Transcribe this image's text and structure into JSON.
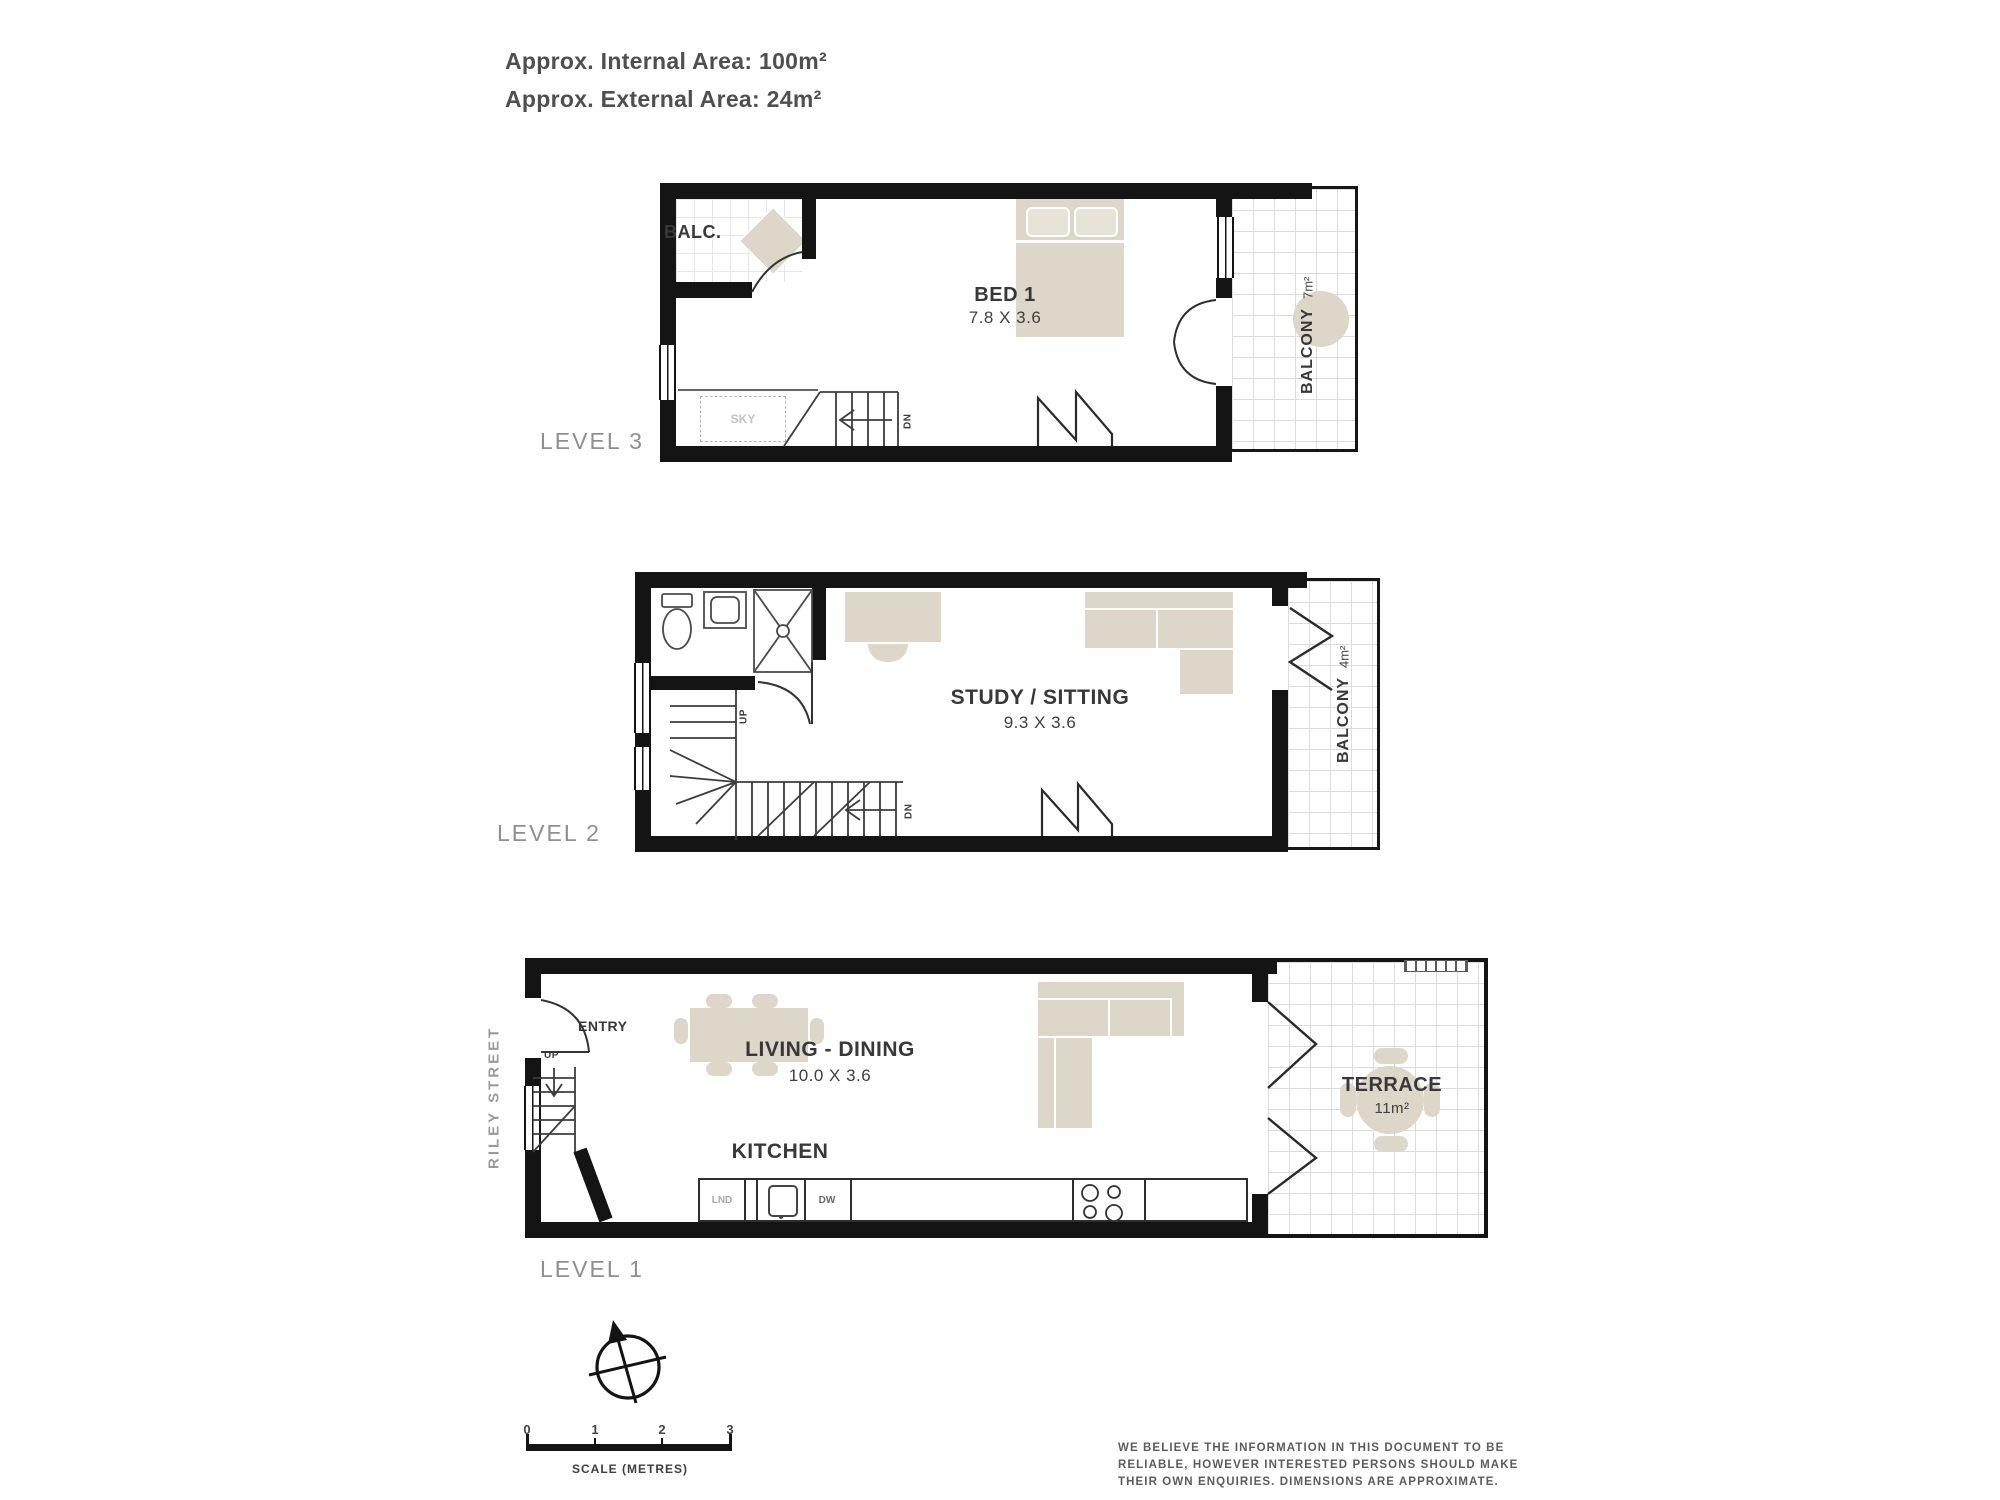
{
  "header": {
    "internal_area": "Approx. Internal Area: 100m²",
    "external_area": "Approx. External Area: 24m²"
  },
  "levels": {
    "level3": {
      "label": "LEVEL 3",
      "balc_label": "BALC.",
      "bed": {
        "name": "BED 1",
        "dims": "7.8 X 3.6"
      },
      "balcony": {
        "name": "BALCONY",
        "area": "7m²"
      },
      "sky_label": "SKY",
      "down_label": "DN"
    },
    "level2": {
      "label": "LEVEL 2",
      "study": {
        "name": "STUDY / SITTING",
        "dims": "9.3 X 3.6"
      },
      "balcony": {
        "name": "BALCONY",
        "area": "4m²"
      },
      "up_label": "UP",
      "down_label": "DN"
    },
    "level1": {
      "label": "LEVEL 1",
      "street_label": "RILEY STREET",
      "entry_label": "ENTRY",
      "up_label": "UP",
      "living": {
        "name": "LIVING - DINING",
        "dims": "10.0 X 3.6"
      },
      "kitchen_label": "KITCHEN",
      "laundry_label": "LND",
      "dishwasher_label": "DW",
      "terrace": {
        "name": "TERRACE",
        "area": "11m²"
      }
    }
  },
  "scale_bar": {
    "ticks": [
      "0",
      "1",
      "2",
      "3"
    ],
    "label": "SCALE (METRES)"
  },
  "disclaimer": {
    "line1": "WE BELIEVE THE INFORMATION IN THIS DOCUMENT TO BE",
    "line2": "RELIABLE, HOWEVER INTERESTED PERSONS SHOULD MAKE",
    "line3": "THEIR OWN ENQUIRIES. DIMENSIONS ARE APPROXIMATE."
  },
  "colors": {
    "wall": "#141414",
    "furniture": "#dcd7c9",
    "level_label_gray": "#8f8f8f",
    "text_dark": "#383838"
  }
}
